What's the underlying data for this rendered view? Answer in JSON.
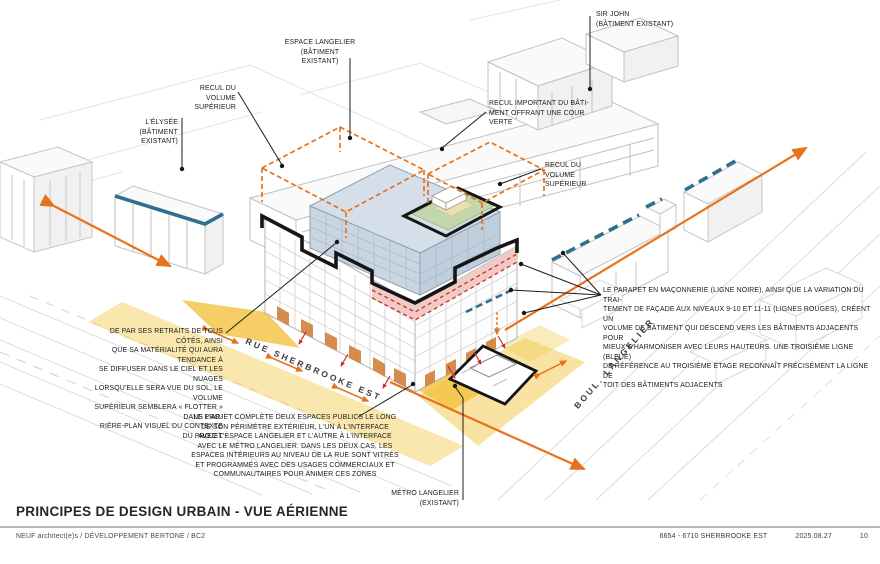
{
  "title": "PRINCIPES DE DESIGN URBAIN - VUE AÉRIENNE",
  "footer": {
    "left": "NEUF architect(e)s  /  DÉVELOPPEMENT BERTONE / BC2",
    "address": "6654 - 6710 SHERBROOKE EST",
    "date": "2025.08.27",
    "page": "10"
  },
  "streets": {
    "sherbrooke": "RUE SHERBROOKE EST",
    "langelier": "BOUL. LANGELIER"
  },
  "callouts": {
    "sir_john": "SIR JOHN\n(BÂTIMENT EXISTANT)",
    "espace_langelier": "ESPACE LANGELIER\n(BÂTIMENT EXISTANT)",
    "recul_volume_sup_left": "RECUL DU\nVOLUME\nSUPÉRIEUR",
    "elysee": "L'ÉLYSÉE\n(BÂTIMENT\nEXISTANT)",
    "recul_important": "RECUL IMPORTANT DU BÂTI-\nMENT OFFRANT UNE COUR\nVERTE",
    "recul_volume_sup_right": "RECUL DU\nVOLUME\nSUPÉRIEUR",
    "parapet_note": "LE PARAPET EN MAÇONNERIE (LIGNE NOIRE), AINSI QUE LA VARIATION DU TRAI-\nTEMENT DE FAÇADE AUX NIVEAUX 9-10 ET 11-11 (LIGNES ROUGES), CRÉENT UN\nVOLUME DE BÂTIMENT QUI DESCEND VERS LES BÂTIMENTS ADJACENTS POUR\nMIEUX S'HARMONISER AVEC LEURS HAUTEURS. UNE TROISIÈME LIGNE (BLEUE)\nDE RÉFÉRENCE AU TROISIÈME ÉTAGE RECONNAÎT PRÉCISÉMENT LA LIGNE DE\nTOIT DES BÂTIMENTS ADJACENTS",
    "retraits_note": "DE PAR SES RETRAITS DE TOUS CÔTÉS, AINSI\nQUE SA MATÉRIALITÉ QUI AURA TENDANCE À\nSE DIFFUSER DANS LE CIEL ET LES NUAGES\nLORSQU'ELLE SERA VUE DU SOL, LE VOLUME\nSUPÉRIEUR SEMBLERA « FLOTTER » DANS L'AR-\nRIÈRE-PLAN VISUEL DU CONTEXTE DU PROJET",
    "espaces_publics_note": "LE PROJET COMPLÈTE DEUX ESPACES PUBLICS LE LONG\nDE SON PÉRIMÈTRE EXTÉRIEUR, L'UN À L'INTERFACE\nAVEC L'ESPACE LANGELIER ET L'AUTRE À L'INTERFACE\nAVEC LE MÉTRO LANGELIER. DANS LES DEUX CAS, LES\nESPACES INTÉRIEURS AU NIVEAU DE LA RUE SONT VITRÉS\nET PROGRAMMÉS AVEC DES USAGES COMMERCIAUX ET\nCOMMUNAUTAIRES POUR ANIMER CES ZONES",
    "metro_langelier": "MÉTRO LANGELIER\n(EXISTANT)"
  },
  "colors": {
    "annotation_black": "#1a1a1a",
    "arrow_orange": "#E8721C",
    "reference_blue": "#2F6F8F",
    "facade_red": "#D22B2B",
    "sidewalk_yellow": "#F3C94F",
    "upper_volume_blue": "#C9D6E2",
    "masonry_pink": "#EFCBC6",
    "roof_green": "#C3D7AD",
    "roof_beige": "#E9DFAF",
    "storefront_orange": "#D2833F",
    "context_grey": "#c6c6c6"
  }
}
